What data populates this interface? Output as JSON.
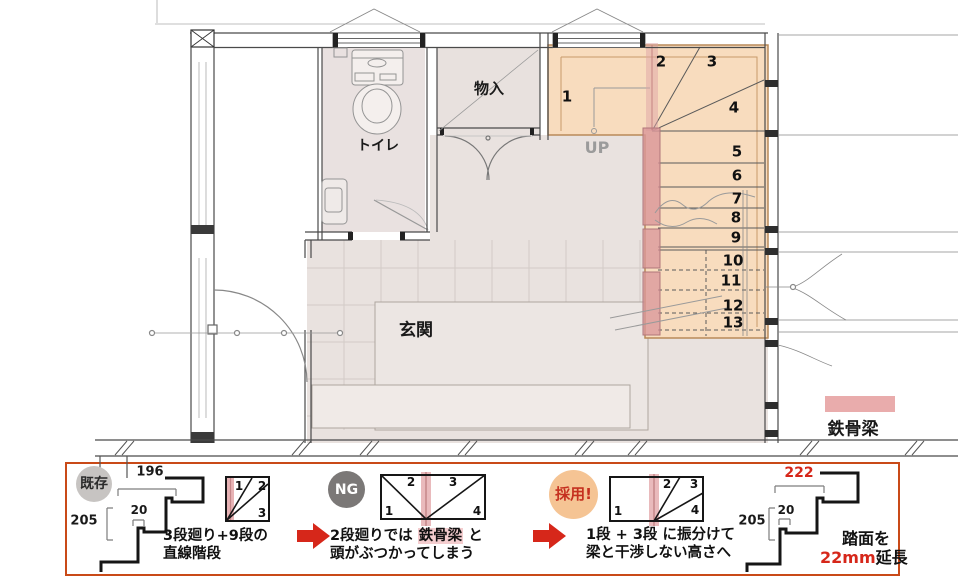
{
  "plan": {
    "labels": {
      "toilet": "トイレ",
      "storage": "物入",
      "entrance": "玄関",
      "up": "UP"
    },
    "steps": [
      "1",
      "2",
      "3",
      "4",
      "5",
      "6",
      "7",
      "8",
      "9",
      "10",
      "11",
      "12",
      "13"
    ],
    "legend": {
      "label": "鉄骨梁",
      "color": "#e9acac"
    }
  },
  "panel": {
    "badges": {
      "existing": "既存",
      "ng": "NG",
      "adopted": "採用!"
    },
    "left_profile": {
      "tread": "196",
      "nosing": "20",
      "riser": "205"
    },
    "right_profile": {
      "tread": "222",
      "nosing": "20",
      "riser": "205"
    },
    "captions": {
      "existing_line1": "3段廻り+9段の",
      "existing_line2": "直線階段",
      "ng_line1_pre": "2段廻りでは ",
      "ng_line1_highlight": "鉄骨梁",
      "ng_line1_post": " と",
      "ng_line2": "頭がぶつかってしまう",
      "adopted_line1": "1段 + 3段 に振分けて",
      "adopted_line2": "梁と干渉しない高さへ",
      "extend_line1": "踏面を",
      "extend_value": "22mm",
      "extend_suffix": "延長"
    },
    "diagram_existing_steps": [
      "1",
      "2",
      "3"
    ],
    "diagram_ng_steps": [
      "1",
      "2",
      "3",
      "4"
    ],
    "diagram_adopted_steps": [
      "1",
      "2",
      "3",
      "4"
    ]
  },
  "colors": {
    "stair_fill": "#f8dcbe",
    "steel_beam": "#dd9b9e",
    "panel_border": "#c94a18",
    "accent_red": "#d6271a"
  }
}
